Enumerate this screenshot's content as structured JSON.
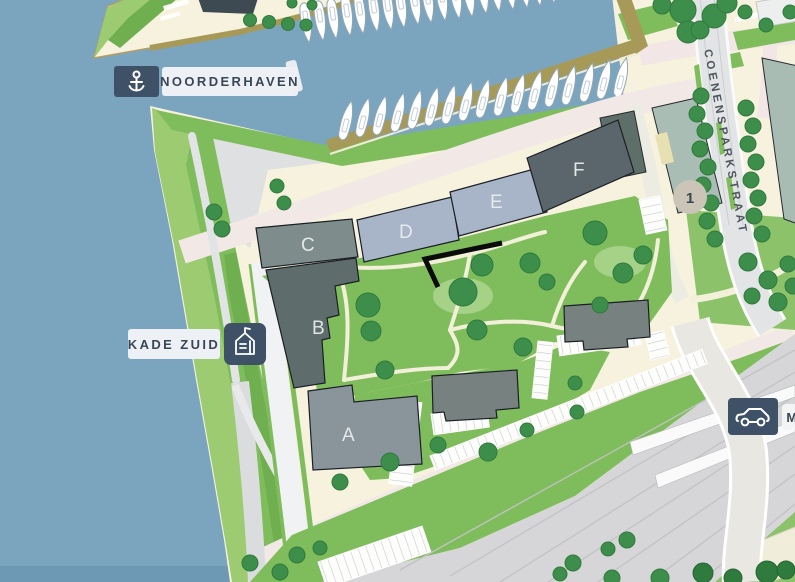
{
  "map": {
    "badges": {
      "noorderhaven": {
        "label": "NOORDERHAVEN",
        "icon": "anchor-icon"
      },
      "kade_zuid": {
        "label": "KADE ZUID",
        "icon": "building-icon"
      },
      "parking": {
        "label": "M",
        "icon": "car-icon"
      }
    },
    "street_label": "COENENSPARKSTRAAT",
    "marker_1": {
      "label": "1"
    },
    "buildings": [
      {
        "id": "A",
        "label": "A",
        "color": "#8A949B"
      },
      {
        "id": "B",
        "label": "B",
        "color": "#5E6C6C"
      },
      {
        "id": "C",
        "label": "C",
        "color": "#7E8C8C"
      },
      {
        "id": "D",
        "label": "D",
        "color": "#A8B4C7"
      },
      {
        "id": "E",
        "label": "E",
        "color": "#A8B4C7"
      },
      {
        "id": "F",
        "label": "F",
        "color": "#5A666C"
      }
    ],
    "colors": {
      "water": "#7BA5BF",
      "water_dark": "#6E99B5",
      "land": "#F6F2DE",
      "green_light": "#9CCB72",
      "green_mid": "#7FBD5C",
      "tree": "#3E8E4B",
      "road_pink": "#F2E9E6",
      "road_gray": "#E2E4E6",
      "dock_rim": "#A79A58",
      "badge_navy": "#3E5166",
      "badge_light": "#EDF1F6",
      "marker_circle": "#CBC5B8",
      "text_dark": "#3A4654"
    }
  }
}
